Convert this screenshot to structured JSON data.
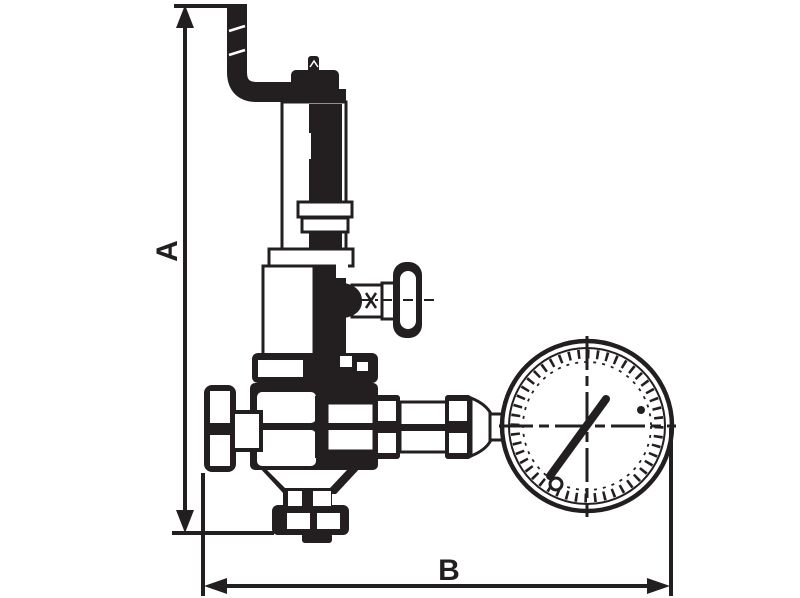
{
  "drawing": {
    "subject": "pressure relief valve with discharge pipe, handwheel and pressure gauge - dimensioned outline drawing",
    "line_color": "#231f20",
    "background_color": "#ffffff",
    "dimension_labels": {
      "vertical": "A",
      "horizontal": "B"
    }
  }
}
